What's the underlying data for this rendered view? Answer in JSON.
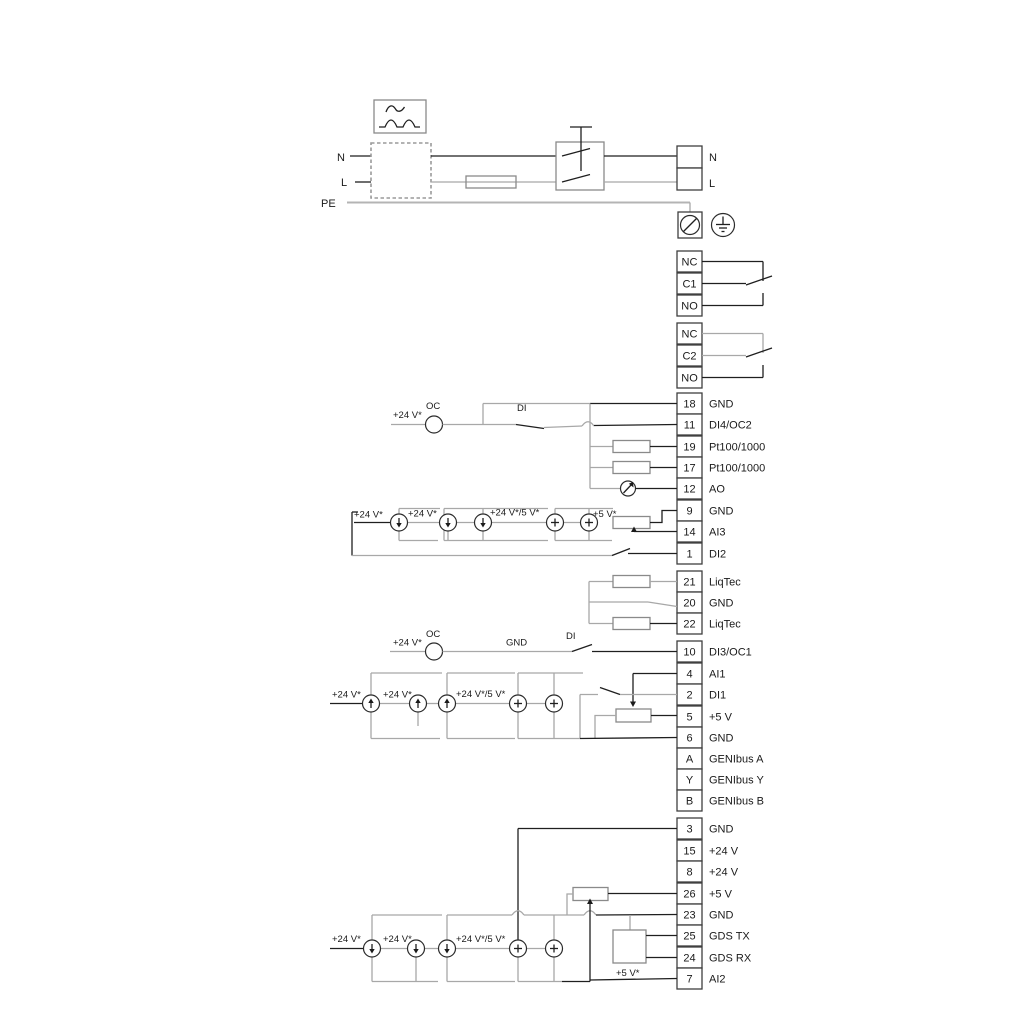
{
  "diagram": {
    "power": {
      "n_left": "N",
      "l_left": "L",
      "pe": "PE",
      "n_right": "N",
      "l_right": "L"
    },
    "relays": [
      {
        "terminals": [
          "NC",
          "C1",
          "NO"
        ]
      },
      {
        "terminals": [
          "NC",
          "C2",
          "NO"
        ]
      }
    ],
    "labels": {
      "v24": "+24 V*",
      "v24_5": "+24 V*/5 V*",
      "v5": "+5 V*",
      "oc": "OC",
      "di": "DI",
      "gnd": "GND"
    },
    "terminals": {
      "io1": [
        {
          "id": "18",
          "label": "GND"
        },
        {
          "id": "11",
          "label": "DI4/OC2"
        },
        {
          "id": "19",
          "label": "Pt100/1000"
        },
        {
          "id": "17",
          "label": "Pt100/1000"
        },
        {
          "id": "12",
          "label": "AO"
        },
        {
          "id": "9",
          "label": "GND"
        },
        {
          "id": "14",
          "label": "AI3"
        },
        {
          "id": "1",
          "label": "DI2"
        }
      ],
      "liqtec": [
        {
          "id": "21",
          "label": "LiqTec"
        },
        {
          "id": "20",
          "label": "GND"
        },
        {
          "id": "22",
          "label": "LiqTec"
        }
      ],
      "io2": [
        {
          "id": "10",
          "label": "DI3/OC1"
        },
        {
          "id": "4",
          "label": "AI1"
        },
        {
          "id": "2",
          "label": "DI1"
        },
        {
          "id": "5",
          "label": "+5 V"
        },
        {
          "id": "6",
          "label": "GND"
        },
        {
          "id": "A",
          "label": "GENIbus A"
        },
        {
          "id": "Y",
          "label": "GENIbus Y"
        },
        {
          "id": "B",
          "label": "GENIbus B"
        }
      ],
      "io3": [
        {
          "id": "3",
          "label": "GND"
        },
        {
          "id": "15",
          "label": "+24 V"
        },
        {
          "id": "8",
          "label": "+24 V"
        },
        {
          "id": "26",
          "label": "+5 V"
        },
        {
          "id": "23",
          "label": "GND"
        },
        {
          "id": "25",
          "label": "GDS TX"
        },
        {
          "id": "24",
          "label": "GDS RX"
        },
        {
          "id": "7",
          "label": "AI2"
        }
      ]
    },
    "colors": {
      "wire": "#1f1f1f",
      "wire_alt": "#a8a8a8",
      "component_stroke": "#8a8a8a",
      "terminal_stroke": "#3f3f3f",
      "background": "#ffffff"
    }
  }
}
